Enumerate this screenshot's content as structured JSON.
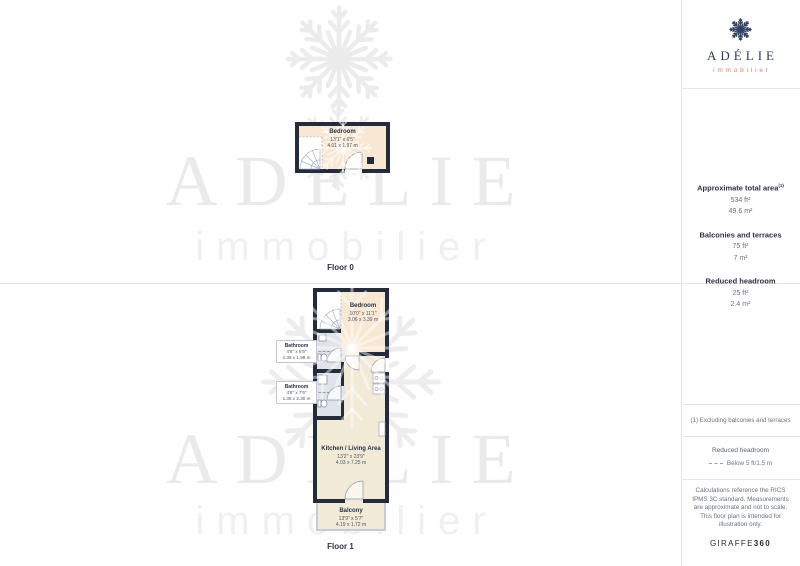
{
  "brand": {
    "name": "ADÉLIE",
    "subtitle": "immobilier"
  },
  "sidebar": {
    "stats": [
      {
        "label": "Approximate total area",
        "sup": "(1)",
        "imperial": "534 ft²",
        "metric": "49.6 m²"
      },
      {
        "label": "Balconies and terraces",
        "sup": "",
        "imperial": "75 ft²",
        "metric": "7 m²"
      },
      {
        "label": "Reduced headroom",
        "sup": "",
        "imperial": "25 ft²",
        "metric": "2.4 m²"
      }
    ],
    "footnote": "(1) Excluding balconies and terraces",
    "legend_title": "Reduced headroom",
    "legend_item": "Below 5 ft/1.5 m",
    "disclaimer": "Calculations reference the RICS IPMS 3C standard. Measurements are approximate and not to scale. This floor plan is intended for illustration only.",
    "brand_name": "GIRAFFE",
    "brand_suffix": "360"
  },
  "floor0": {
    "label": "Floor 0",
    "bedroom": {
      "name": "Bedroom",
      "imperial": "13'1\" x 6'5\"",
      "metric": "4.01 x 1.97 m"
    }
  },
  "floor1": {
    "label": "Floor 1",
    "bedroom": {
      "name": "Bedroom",
      "imperial": "10'0\" x 11'1\"",
      "metric": "3.06 x 3.39 m"
    },
    "bathroom1": {
      "name": "Bathroom",
      "imperial": "4'6\" x 6'5\"",
      "metric": "1.38 x 1.98 m"
    },
    "bathroom2": {
      "name": "Bathroom",
      "imperial": "4'6\" x 7'6\"",
      "metric": "1.38 x 2.30 m"
    },
    "kitchen": {
      "name": "Kitchen / Living Area",
      "imperial": "13'2\" x 23'9\"",
      "metric": "4.03 x 7.25 m"
    },
    "balcony": {
      "name": "Balcony",
      "imperial": "13'9\" x 5'7\"",
      "metric": "4.19 x 1.72 m"
    }
  },
  "colors": {
    "wall": "#242b3a",
    "navy_text": "#2b3347",
    "accent_coral": "#dd7f6a",
    "bedroom_fill": "#f8e7d3",
    "kitchen_fill": "#f1ead6",
    "bathroom_fill": "#dfe3ea",
    "balcony_wall": "#c6cad3",
    "watermark": "#ebebeb"
  }
}
